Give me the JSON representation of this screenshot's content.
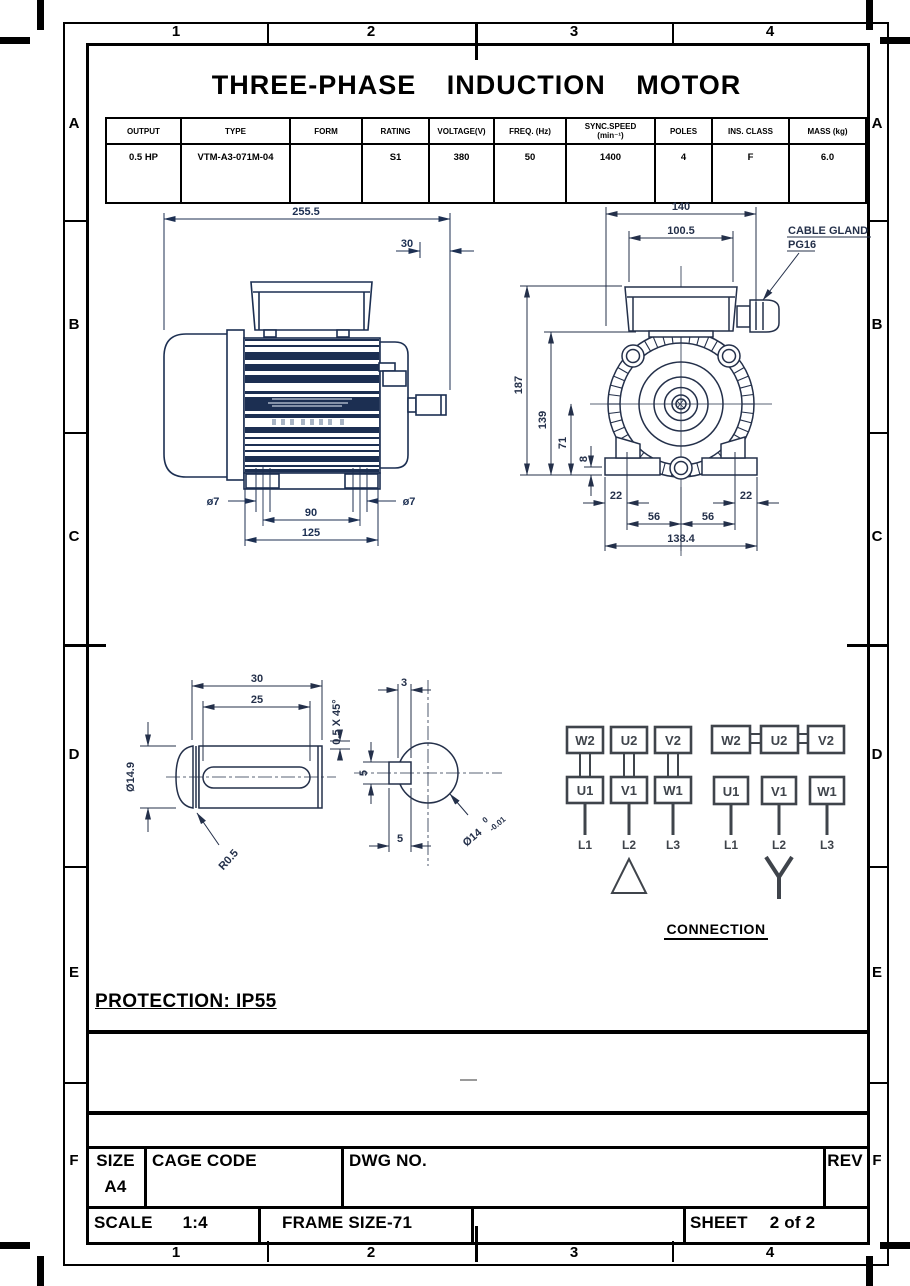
{
  "title": "THREE-PHASE INDUCTION MOTOR",
  "zones": {
    "cols": [
      "1",
      "2",
      "3",
      "4"
    ],
    "rows": [
      "A",
      "B",
      "C",
      "D",
      "E",
      "F"
    ]
  },
  "spec_table": {
    "headers": [
      "OUTPUT",
      "TYPE",
      "FORM",
      "RATING",
      "VOLTAGE(V)",
      "FREQ. (Hz)",
      "SYNC.SPEED",
      "POLES",
      "INS. CLASS",
      "MASS (kg)"
    ],
    "sync_sub": "(min⁻¹)",
    "values": [
      "0.5 HP",
      "VTM-A3-071M-04",
      "",
      "S1",
      "380",
      "50",
      "1400",
      "4",
      "F",
      "6.0"
    ]
  },
  "side_view": {
    "dims": {
      "length": "255.5",
      "shaft_len": "30",
      "hole_left": "ø7",
      "hole_right": "ø7",
      "hole_span": "90",
      "foot_len": "125"
    }
  },
  "front_view": {
    "dims": {
      "width": "140",
      "box_width": "100.5",
      "height": "187",
      "body_top": "139",
      "axis_height": "71",
      "pad": "8",
      "off_left": "22",
      "off_right": "22",
      "span_left": "56",
      "span_right": "56",
      "base": "138.4"
    },
    "cable_gland_line1": "CABLE GLAND",
    "cable_gland_line2": "PG16"
  },
  "shaft_side": {
    "dims": {
      "length": "30",
      "key_len": "25",
      "chamfer": "0.5 X 45°",
      "dia": "Ø14.9",
      "fillet": "R0.5"
    }
  },
  "shaft_end": {
    "dims": {
      "key_depth": "3",
      "key_width": "5",
      "key_width_bottom": "5",
      "dia": "Ø14",
      "tol_hi": "0",
      "tol_lo": "-0.01"
    }
  },
  "connection": {
    "caption": "CONNECTION",
    "delta": {
      "top": [
        "W2",
        "U2",
        "V2"
      ],
      "bottom": [
        "U1",
        "V1",
        "W1"
      ],
      "lines": [
        "L1",
        "L2",
        "L3"
      ]
    },
    "star": {
      "top": [
        "W2",
        "U2",
        "V2"
      ],
      "bottom": [
        "U1",
        "V1",
        "W1"
      ],
      "lines": [
        "L1",
        "L2",
        "L3"
      ]
    }
  },
  "protection": "PROTECTION: IP55",
  "title_block": {
    "size_label": "SIZE",
    "size_value": "A4",
    "cage_code_label": "CAGE CODE",
    "dwg_no_label": "DWG NO.",
    "rev_label": "REV",
    "scale_label": "SCALE",
    "scale_value": "1:4",
    "frame_label": "FRAME SIZE-71",
    "sheet_label": "SHEET",
    "sheet_value": "2 of 2"
  },
  "colors": {
    "side_ink": "#1c2f52",
    "front_ink": "#24304a",
    "connection_ink": "#3f444b",
    "nameplate": "#a8b4c4",
    "black": "#000000"
  }
}
